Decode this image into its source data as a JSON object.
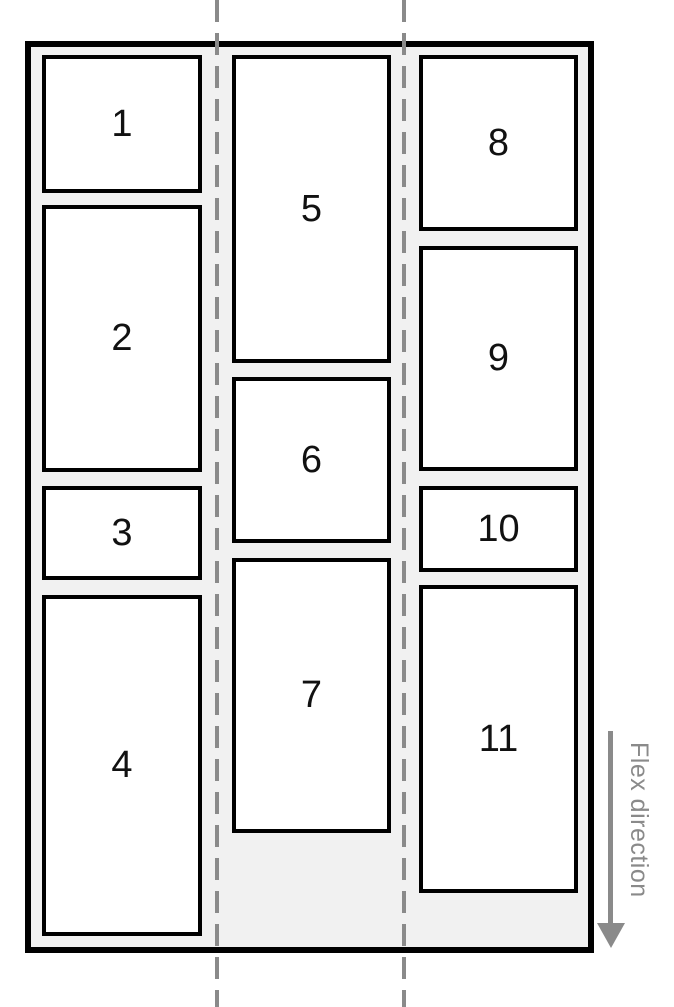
{
  "diagram_kind": "flexbox-column-wrap-illustration",
  "items": [
    {
      "label": "1"
    },
    {
      "label": "2"
    },
    {
      "label": "3"
    },
    {
      "label": "4"
    },
    {
      "label": "5"
    },
    {
      "label": "6"
    },
    {
      "label": "7"
    },
    {
      "label": "8"
    },
    {
      "label": "9"
    },
    {
      "label": "10"
    },
    {
      "label": "11"
    }
  ],
  "annotation": {
    "flex_direction_label": "Flex direction",
    "arrow_direction": "down"
  },
  "colors": {
    "border_black": "#000000",
    "container_background": "#F1F1F1",
    "item_background": "#FFFFFF",
    "guide_gray": "#8A8A8A",
    "number_text": "#111111",
    "page_background": "#FFFFFF"
  }
}
